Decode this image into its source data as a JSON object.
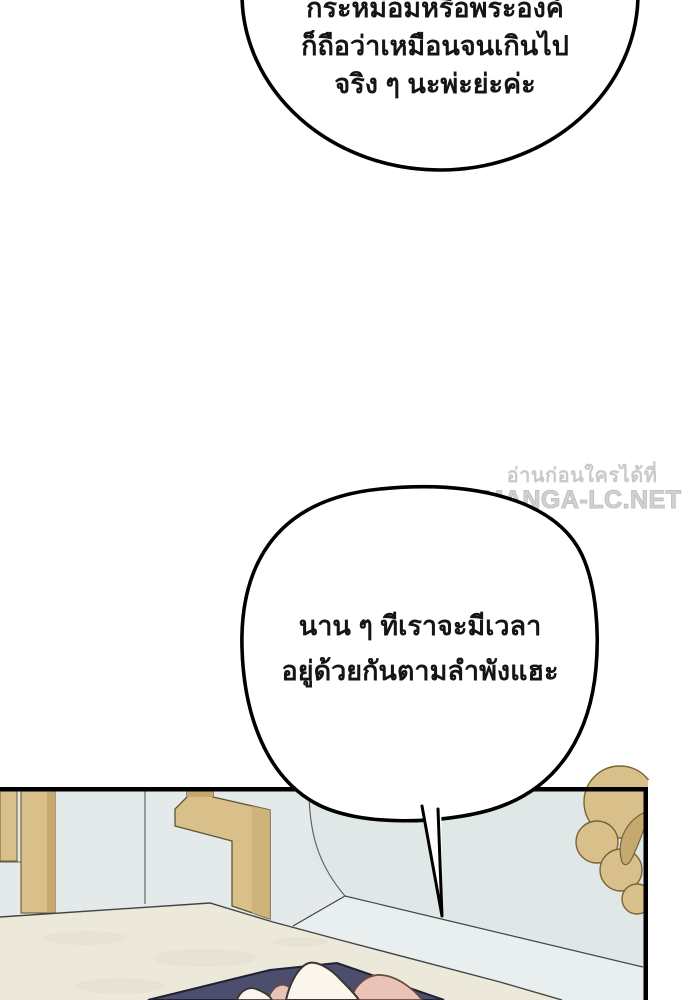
{
  "page": {
    "background_color": "#ffffff"
  },
  "bubbles": [
    {
      "name": "bubble-top",
      "lines": [
        "กระหม่อมหรือพระองค์",
        "ก็ถือว่าเหมือนจนเกินไป",
        "จริง ๆ นะพ่ะย่ะค่ะ"
      ]
    },
    {
      "name": "bubble-middle",
      "lines": [
        "นาน ๆ ทีเราจะมีเวลา",
        "อยู่ด้วยกันตามลำพังแฮะ"
      ]
    }
  ],
  "watermark": {
    "line1": "อ่านก่อนใครได้ที่",
    "line2": "MANGA-LC.NET",
    "text_color": "#c9c9c9"
  },
  "illustration": {
    "colors": {
      "wall": "#e3eae9",
      "wall_right": "#dfe7e7",
      "wall_wedge": "#e9efee",
      "floor": "#ece8da",
      "floor_texture": "#e3dfd0",
      "gold": "#d9c08a",
      "gold_dark": "#c6a96f",
      "gold_mid": "#cdb177",
      "navy": "#4b4f6d",
      "skin_pink": "#e9c3b5",
      "white_shape": "#faf6ee",
      "bubble_fill": "#ffffff",
      "outline": "#3f4444",
      "border": "#000000"
    }
  }
}
